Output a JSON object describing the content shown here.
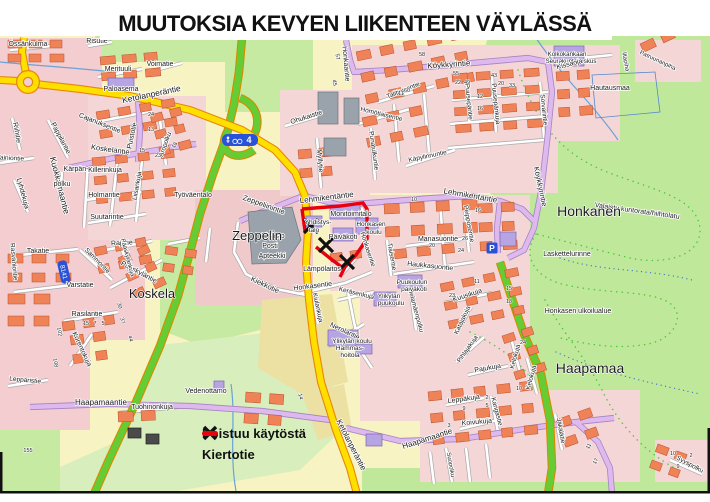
{
  "title": "MUUTOKSIA KEVYEN LIIKENTEEN VÄYLÄSSÄ",
  "legend": {
    "items": [
      {
        "symbol": "x-mark",
        "label": "Poistuu käytöstä"
      },
      {
        "symbol": "red-line",
        "label": "Kiertotie"
      }
    ]
  },
  "badges": {
    "route_number": "8141",
    "cycle_route": "4",
    "parking": "P"
  },
  "colors": {
    "road_yellow": "#ffdf00",
    "road_green": "#66cc33",
    "road_lilac": "#ddb9ee",
    "detour_red": "#e8000e",
    "badge_blue": "#2a52d8",
    "forest_green": "#bfe89b",
    "block_pink": "#f3cdd0",
    "building_orange": "#ef8256",
    "building_purple": "#b7a4e3"
  },
  "map_labels": {
    "areas": [
      [
        "Koskela",
        152,
        298,
        0,
        13
      ],
      [
        "Zeppelin",
        257,
        240,
        0,
        13
      ],
      [
        "Honkanen",
        589,
        216,
        0,
        14
      ],
      [
        "Haapamaa",
        590,
        373,
        0,
        14
      ]
    ],
    "streets": [
      [
        "Ketolanperäntie",
        152,
        97,
        -12,
        8.5
      ],
      [
        "Kuokkamaantie",
        57,
        186,
        76,
        8.5
      ],
      [
        "Koskelantie",
        110,
        152,
        8,
        7.5
      ],
      [
        "Cajanuksentie",
        99,
        125,
        22,
        7
      ],
      [
        "Puistotie",
        134,
        136,
        -78,
        7
      ],
      [
        "Aropolku",
        167,
        145,
        -70,
        6.5
      ],
      [
        "Pappilantie",
        59,
        139,
        62,
        7
      ],
      [
        "Riihitie",
        15,
        133,
        80,
        7
      ],
      [
        "Lyhdekuja",
        21,
        194,
        75,
        7
      ],
      [
        "Vainiontie",
        10,
        160,
        3,
        6.5
      ],
      [
        "Kärpän-",
        76,
        171,
        0,
        7
      ],
      [
        "Killerinkuja",
        105,
        172,
        0,
        7
      ],
      [
        "polku",
        62,
        186,
        0,
        7
      ],
      [
        "Liisankuja",
        139,
        186,
        -80,
        6.5
      ],
      [
        "Holmantie",
        104,
        197,
        0,
        7
      ],
      [
        "Suutarintie",
        107,
        219,
        0,
        7
      ],
      [
        "Räsväniontie",
        12,
        262,
        85,
        6.5
      ],
      [
        "Takatie",
        38,
        253,
        0,
        7
      ],
      [
        "Varstatie",
        80,
        287,
        0,
        7
      ],
      [
        "Sammontie",
        96,
        262,
        45,
        6.5
      ],
      [
        "Rajatie",
        122,
        245,
        -3,
        7
      ],
      [
        "Pääskyläntie",
        138,
        274,
        28,
        7
      ],
      [
        "Pääskylänkuja",
        126,
        258,
        75,
        6
      ],
      [
        "Rasilantie",
        87,
        316,
        0,
        7
      ],
      [
        "Korentokuja",
        80,
        350,
        65,
        7
      ],
      [
        "Leppäristie",
        25,
        382,
        5,
        6.5
      ],
      [
        "Tuohinonkuja",
        152,
        409,
        0,
        7
      ],
      [
        "Zeppeliinintie",
        263,
        207,
        20,
        7.5
      ],
      [
        "Kiekkotie",
        264,
        287,
        25,
        7.5
      ],
      [
        "Myllytie",
        318,
        161,
        85,
        7
      ],
      [
        "Ohukaistie",
        307,
        119,
        -18,
        7
      ],
      [
        "Honkaantie",
        344,
        64,
        85,
        7
      ],
      [
        "Köykkyrintie",
        449,
        67,
        -4,
        8
      ],
      [
        "Köykkyrintie",
        538,
        187,
        78,
        7.5
      ],
      [
        "Talitiaisentie",
        404,
        92,
        -22,
        6.5
      ],
      [
        "Hömötiaisentie",
        381,
        116,
        14,
        6.5
      ],
      [
        "Punatulkuntie",
        372,
        151,
        82,
        6.5
      ],
      [
        "Käpylinnuntie",
        428,
        158,
        -12,
        6.5
      ],
      [
        "Puusepäntie",
        467,
        102,
        84,
        6.5
      ],
      [
        "Puusepänkuja",
        494,
        104,
        84,
        6.5
      ],
      [
        "Sorvarintie",
        542,
        110,
        84,
        6.5
      ],
      [
        "Lehmikentäntie",
        327,
        200,
        -7,
        8
      ],
      [
        "Lehmikentäntie",
        470,
        198,
        10,
        8
      ],
      [
        "Peipposentie",
        467,
        224,
        80,
        6.5
      ],
      [
        "Manasuontie",
        438,
        241,
        0,
        7
      ],
      [
        "Haukkasuontie",
        430,
        268,
        6,
        7
      ],
      [
        "Tiaisentie",
        390,
        257,
        80,
        6.5
      ],
      [
        "Honkasentie",
        313,
        288,
        -7,
        7
      ],
      [
        "Honkasentie",
        366,
        250,
        72,
        6.5
      ],
      [
        "Kiulankuja",
        316,
        308,
        78,
        6.5
      ],
      [
        "Keräsenkuja",
        356,
        295,
        14,
        6.5
      ],
      [
        "Nerolantie",
        344,
        333,
        25,
        7
      ],
      [
        "Helamäenpolku",
        414,
        311,
        75,
        6.5
      ],
      [
        "Kuusikuja",
        468,
        297,
        -18,
        7
      ],
      [
        "Katajakuja",
        464,
        321,
        -65,
        6.5
      ],
      [
        "Pihlajakuja",
        469,
        350,
        -55,
        6.5
      ],
      [
        "Pajukuja",
        488,
        370,
        -10,
        7
      ],
      [
        "Kelokuja",
        517,
        357,
        -75,
        6.5
      ],
      [
        "Kelokuja",
        533,
        378,
        -75,
        6.5
      ],
      [
        "Leppäkuja",
        464,
        401,
        -8,
        7
      ],
      [
        "Koivukuja",
        477,
        424,
        -5,
        7
      ],
      [
        "Kangastie",
        495,
        412,
        75,
        6.5
      ],
      [
        "Haapamaantie",
        101,
        405,
        0,
        8
      ],
      [
        "Haapamaantie",
        428,
        441,
        -18,
        8
      ],
      [
        "Ketolanperäntie",
        349,
        446,
        63,
        8
      ],
      [
        "Jäkälätie",
        559,
        431,
        80,
        6.5
      ],
      [
        "Suopolku",
        449,
        465,
        80,
        6
      ],
      [
        "Syyspolku",
        689,
        466,
        28,
        6.5
      ],
      [
        "Patruunanpiha",
        657,
        62,
        25,
        6
      ],
      [
        "Iltapiha",
        624,
        62,
        80,
        6
      ]
    ],
    "pois": [
      [
        "Össänkulma",
        28,
        46,
        0,
        7
      ],
      [
        "Risutie",
        97,
        43,
        0,
        7
      ],
      [
        "Merituuli",
        118,
        71,
        0,
        7
      ],
      [
        "Voimatie",
        160,
        66,
        0,
        7
      ],
      [
        "Paloasema",
        121,
        91,
        0,
        7
      ],
      [
        "Työväentalo",
        193,
        197,
        0,
        7
      ],
      [
        "Kirjasto",
        273,
        238,
        0,
        7
      ],
      [
        "Posti",
        270,
        248,
        0,
        7
      ],
      [
        "Apteekki",
        272,
        258,
        0,
        7
      ],
      [
        "Monitoimitalo",
        351,
        216,
        0,
        7
      ],
      [
        "Yhdistys-",
        318,
        224,
        0,
        6.5
      ],
      [
        "talo",
        314,
        232,
        0,
        6.5
      ],
      [
        "Honkasen",
        371,
        226,
        0,
        6.5
      ],
      [
        "koulu",
        374,
        234,
        0,
        6.5
      ],
      [
        "Päiväkoti",
        343,
        239,
        0,
        7
      ],
      [
        "Lämpölaitos",
        322,
        271,
        0,
        7
      ],
      [
        "Kolkokankaan",
        567,
        56,
        0,
        6.2
      ],
      [
        "Seurakuntakeskus",
        571,
        63,
        0,
        6.2
      ],
      [
        "Hautausmaa",
        610,
        90,
        0,
        7
      ],
      [
        "Kissaoja",
        570,
        66,
        -14,
        7,
        "#3a6fc4"
      ],
      [
        "Valaistu kuntorata/hiihtolatu",
        637,
        213,
        8,
        7
      ],
      [
        "Laskettelurinne",
        567,
        256,
        0,
        7
      ],
      [
        "Honkasen ulkoilualue",
        578,
        313,
        0,
        7
      ],
      [
        "Puukoulun",
        412,
        284,
        0,
        6.5
      ],
      [
        "päiväkoti",
        414,
        291,
        0,
        6.5
      ],
      [
        "Ylikylän",
        389,
        298,
        0,
        6.5
      ],
      [
        "puukoulu",
        391,
        305,
        0,
        6.5
      ],
      [
        "Ylikylän koulu",
        352,
        343,
        0,
        6.5
      ],
      [
        "Hammas-",
        350,
        350,
        0,
        6.5
      ],
      [
        "hoitola",
        350,
        357,
        0,
        6.5
      ],
      [
        "Vedenottamo",
        206,
        393,
        0,
        7
      ]
    ],
    "numbers": [
      [
        "102",
        58,
        332,
        80
      ],
      [
        "108",
        54,
        363,
        80
      ],
      [
        "155",
        28,
        452,
        0
      ],
      [
        "30",
        118,
        306,
        75
      ],
      [
        "37",
        121,
        321,
        75
      ],
      [
        "44",
        129,
        339,
        75
      ],
      [
        "15",
        86,
        325,
        0
      ],
      [
        "7",
        95,
        325,
        0
      ],
      [
        "5",
        103,
        325,
        0
      ],
      [
        "24",
        151,
        116,
        0
      ],
      [
        "13",
        151,
        131,
        0
      ],
      [
        "15",
        142,
        152,
        0
      ],
      [
        "23",
        158,
        157,
        0
      ],
      [
        "18",
        176,
        146,
        -60
      ],
      [
        "57",
        336,
        57,
        80
      ],
      [
        "45",
        333,
        83,
        80
      ],
      [
        "58",
        422,
        56,
        0
      ],
      [
        "55",
        456,
        75,
        0
      ],
      [
        "22",
        458,
        84,
        0
      ],
      [
        "49",
        467,
        84,
        0
      ],
      [
        "43",
        494,
        77,
        0
      ],
      [
        "20",
        501,
        85,
        0
      ],
      [
        "33",
        512,
        87,
        0
      ],
      [
        "11",
        401,
        95,
        0
      ],
      [
        "60",
        407,
        92,
        0
      ],
      [
        "12",
        480,
        98,
        0
      ],
      [
        "16",
        480,
        110,
        0
      ],
      [
        "10",
        414,
        201,
        0
      ],
      [
        "16",
        478,
        212,
        0
      ],
      [
        "26",
        465,
        240,
        0
      ],
      [
        "20",
        432,
        247,
        0
      ],
      [
        "24",
        461,
        252,
        0
      ],
      [
        "11",
        477,
        283,
        0
      ],
      [
        "23",
        452,
        297,
        0
      ],
      [
        "15",
        509,
        290,
        0
      ],
      [
        "18",
        509,
        303,
        0
      ],
      [
        "24",
        523,
        344,
        0
      ],
      [
        "10",
        519,
        390,
        0
      ],
      [
        "9",
        464,
        410,
        0
      ],
      [
        "3",
        449,
        427,
        0
      ],
      [
        "2",
        487,
        399,
        0
      ],
      [
        "5",
        487,
        407,
        0
      ],
      [
        "11",
        590,
        447,
        -60
      ],
      [
        "17",
        597,
        462,
        -60
      ],
      [
        "10",
        673,
        455,
        0
      ],
      [
        "2",
        691,
        457,
        0
      ],
      [
        "9",
        678,
        468,
        0
      ],
      [
        "14",
        299,
        397,
        75
      ]
    ]
  }
}
